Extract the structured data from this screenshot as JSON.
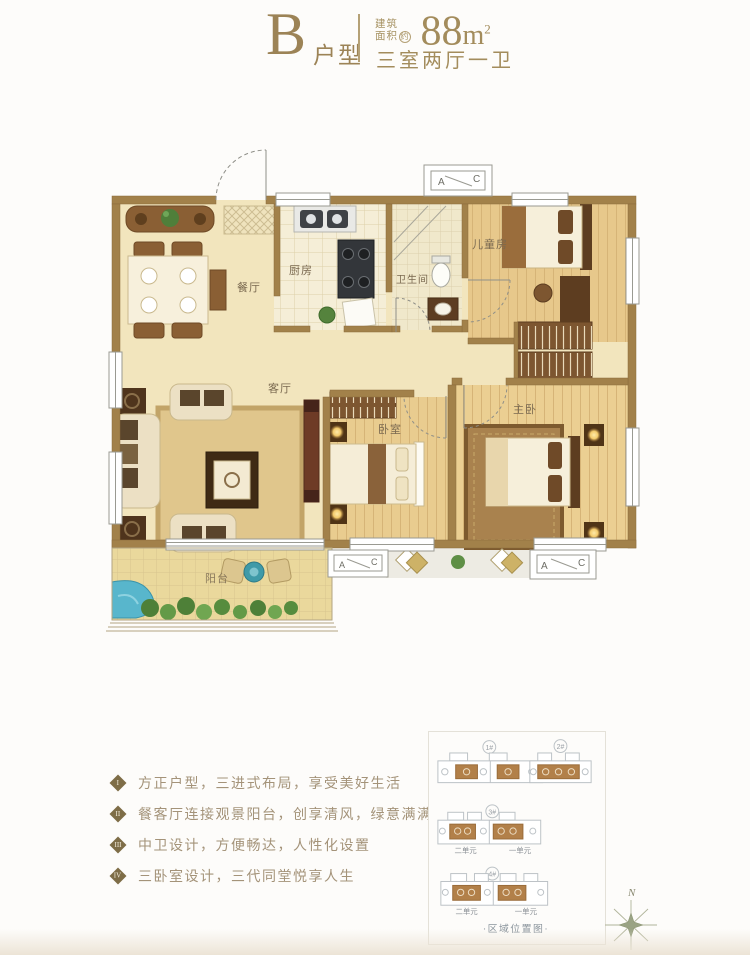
{
  "header": {
    "type_letter": "B",
    "type_suffix": "户型",
    "area_label_top": "建筑",
    "area_label_bottom": "面积",
    "area_label_approx": "约",
    "area_value": "88",
    "area_unit": "m",
    "area_exponent": "2",
    "rooms_summary": "三室两厅一卫"
  },
  "floorplan": {
    "rooms": {
      "dining": "餐厅",
      "kitchen": "厨房",
      "bathroom": "卫生间",
      "kids_room": "儿童房",
      "living": "客厅",
      "bedroom": "卧室",
      "master": "主卧",
      "balcony": "阳台"
    },
    "ac_a": "A",
    "ac_c": "C"
  },
  "features": [
    {
      "num": "I",
      "text": "方正户型，三进式布局，享受美好生活"
    },
    {
      "num": "II",
      "text": "餐客厅连接观景阳台，创享清风，绿意满满"
    },
    {
      "num": "III",
      "text": "中卫设计，方便畅达，人性化设置"
    },
    {
      "num": "IV",
      "text": "三卧室设计，三代同堂悦享人生"
    }
  ],
  "site_map": {
    "title": "·区域位置图·",
    "compass_n": "N",
    "buildings": [
      {
        "label": "1#"
      },
      {
        "label": "2#"
      },
      {
        "label": "3#",
        "left_unit": "二单元",
        "right_unit": "一单元"
      },
      {
        "label": "4#",
        "left_unit": "二单元",
        "right_unit": "一单元"
      }
    ]
  },
  "colors": {
    "accent_gold": "#a38c5c",
    "wall_brown": "#a2814a",
    "floor_cream": "#f2e5bd",
    "wood_tan": "#e8cb8e",
    "highlight_unit_brown": "#b28049",
    "feature_text": "#a49379"
  }
}
